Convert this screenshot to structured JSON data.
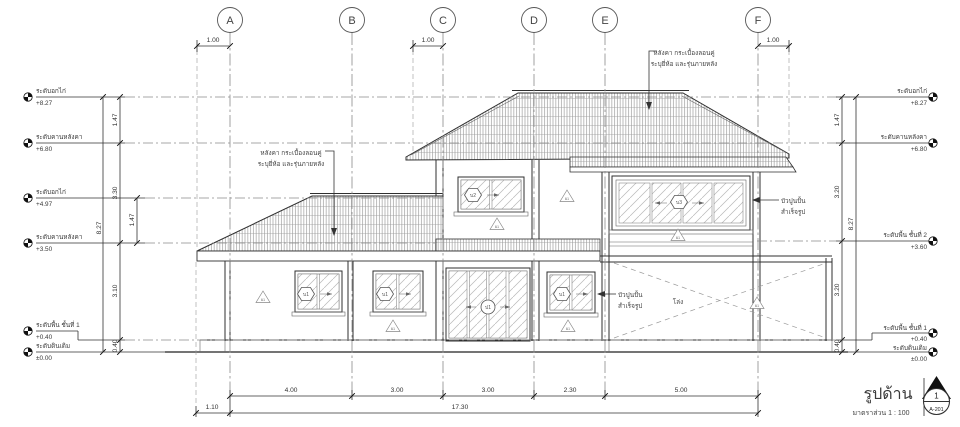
{
  "drawing": {
    "title": "รูปด้าน",
    "scale_label": "มาตราส่วน  1 : 100",
    "sheet_ref": {
      "number": "1",
      "sheet": "A-201"
    }
  },
  "grid": {
    "columns": [
      {
        "label": "A"
      },
      {
        "label": "B"
      },
      {
        "label": "C"
      },
      {
        "label": "D"
      },
      {
        "label": "E"
      },
      {
        "label": "F"
      }
    ],
    "offset_dims": [
      {
        "value": "1.00"
      },
      {
        "value": "1.00"
      },
      {
        "value": "1.00"
      }
    ]
  },
  "levels_left": [
    {
      "name": "ระดับอกไก่",
      "value": "+8.27"
    },
    {
      "name": "ระดับคานหลังคา",
      "value": "+6.80"
    },
    {
      "name": "ระดับอกไก่",
      "value": "+4.97"
    },
    {
      "name": "ระดับคานหลังคา",
      "value": "+3.50"
    },
    {
      "name": "ระดับพื้น ชั้นที่ 1",
      "value": "+0.40"
    },
    {
      "name": "ระดับดินเดิม",
      "value": "±0.00"
    }
  ],
  "levels_right": [
    {
      "name": "ระดับอกไก่",
      "value": "+8.27"
    },
    {
      "name": "ระดับคานหลังคา",
      "value": "+6.80"
    },
    {
      "name": "ระดับพื้น ชั้นที่ 2",
      "value": "+3.60"
    },
    {
      "name": "ระดับพื้น ชั้นที่ 1",
      "value": "+0.40"
    },
    {
      "name": "ระดับดินเดิม",
      "value": "±0.00"
    }
  ],
  "dims_left": {
    "overall": "8.27",
    "chain": [
      "1.47",
      "3.30",
      "3.10",
      "0.40"
    ],
    "inner": "1.47"
  },
  "dims_right": {
    "overall": "8.27",
    "chain": [
      "1.47",
      "3.20",
      "3.20",
      "0.40"
    ]
  },
  "dims_bottom": {
    "offset": "1.10",
    "segments": [
      "4.00",
      "3.00",
      "3.00",
      "2.30",
      "5.00"
    ],
    "total": "17.30"
  },
  "notes": {
    "roof_left": {
      "line1": "หลังคา กระเบื้องลอนคู่",
      "line2": "ระบุยี่ห้อ และรุ่นภายหลัง"
    },
    "roof_right": {
      "line1": "หลังคา กระเบื้องลอนคู่",
      "line2": "ระบุยี่ห้อ และรุ่นภายหลัง"
    },
    "molding_mid": {
      "line1": "บัวปูนปั้น",
      "line2": "สำเร็จรูป"
    },
    "molding_right": {
      "line1": "บัวปูนปั้น",
      "line2": "สำเร็จรูป"
    },
    "open_area": "โล่ง"
  },
  "tags": {
    "window_1f": "บ1",
    "window_2f": "บ2",
    "window_2f_large": "บ3",
    "door": "ป1",
    "wall": "ผ1"
  },
  "colors": {
    "line": "#2f2f2f",
    "grid": "#8a8a8a",
    "hatch": "#7a7a7a",
    "bg": "#ffffff"
  }
}
